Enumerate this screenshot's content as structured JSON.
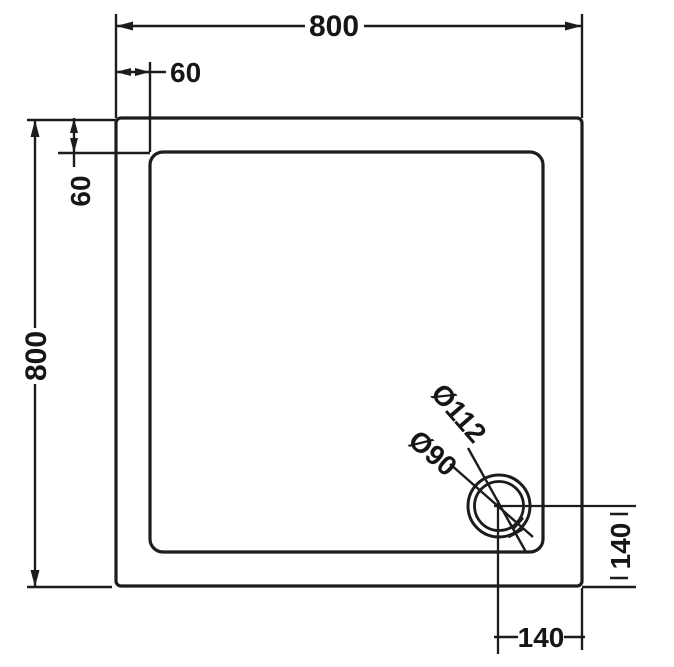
{
  "drawing": {
    "type": "technical-dimension-drawing",
    "subject": "Square shower tray plan view with offset corner waste drain",
    "colors": {
      "line": "#1c1c1c",
      "background": "#ffffff",
      "text": "#161616"
    },
    "dims": {
      "top_width": "800",
      "top_inset": "60",
      "left_height": "800",
      "left_inset": "60",
      "waste_outer_dia": "Ø112",
      "waste_inner_dia": "Ø90",
      "waste_offset_right": "140",
      "waste_offset_bottom": "140"
    }
  }
}
